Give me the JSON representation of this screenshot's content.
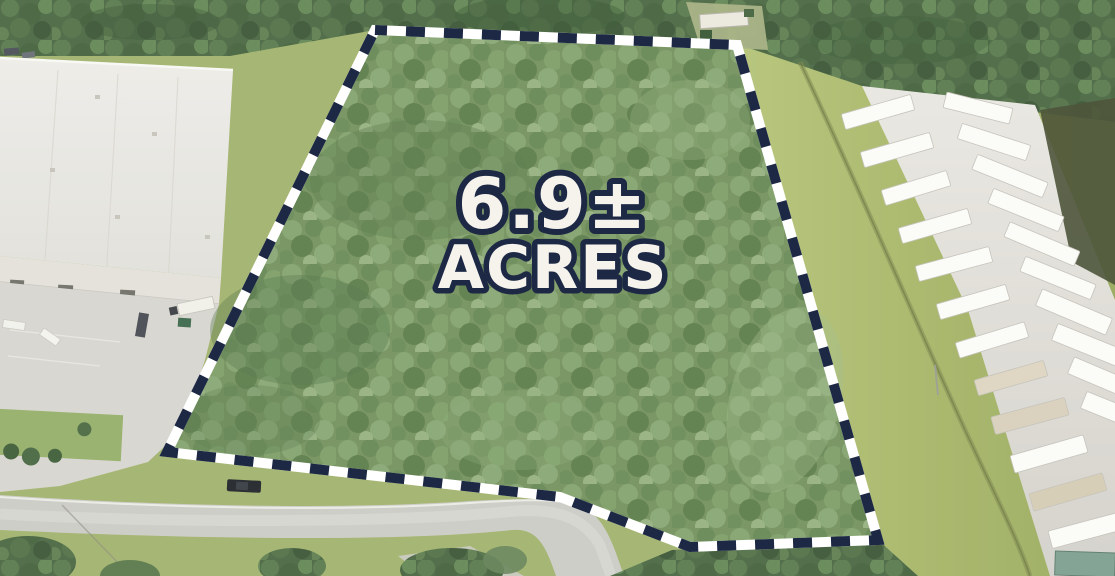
{
  "annotation": {
    "acreage_value": "6.9±",
    "acreage_unit": "ACRES",
    "label_fill": "#f5f3ec",
    "label_outline": "#1d2845"
  },
  "boundary": {
    "dash_dark_color": "#1d2845",
    "dash_light_color": "#ffffff"
  },
  "palette": {
    "forest_dark": "#4c6a45",
    "forest_parcel": "#75935f",
    "grass": "#aab96f",
    "yard_pavement": "#dedcd6",
    "road": "#ccccc6",
    "warehouse_roof": "#e9e8e3",
    "trailer_white": "#fbfbf8"
  }
}
